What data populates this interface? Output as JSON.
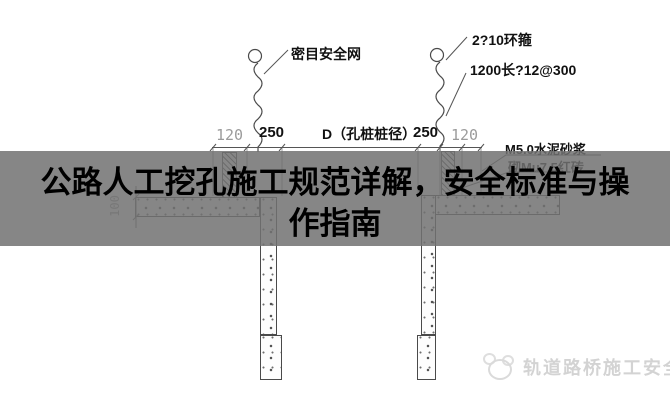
{
  "banner": {
    "title_lines": [
      "公路人工挖孔施工规范详解，安全标准与操",
      "作指南"
    ]
  },
  "diagram": {
    "labels": {
      "safety_net": "密目安全网",
      "ring_hoop": "2?10环箍",
      "rebar": "1200长?12@300",
      "pile_diameter": "D（孔桩桩径）",
      "mortar": "M5.0水泥砂浆",
      "brick": "砌Mu7.5红砖"
    },
    "dimensions": {
      "left_120": "120",
      "left_250": "250",
      "right_250": "250",
      "right_120": "120",
      "slab_100": "100"
    }
  },
  "watermark": {
    "text": "轨道路桥施工安全",
    "logo": "panda-mascot-icon"
  },
  "colors": {
    "overlay_gray": "#717171",
    "line": "#4a4a4a",
    "dim_gray": "#9b9b9b",
    "watermark_gray": "#d3d3d3"
  }
}
